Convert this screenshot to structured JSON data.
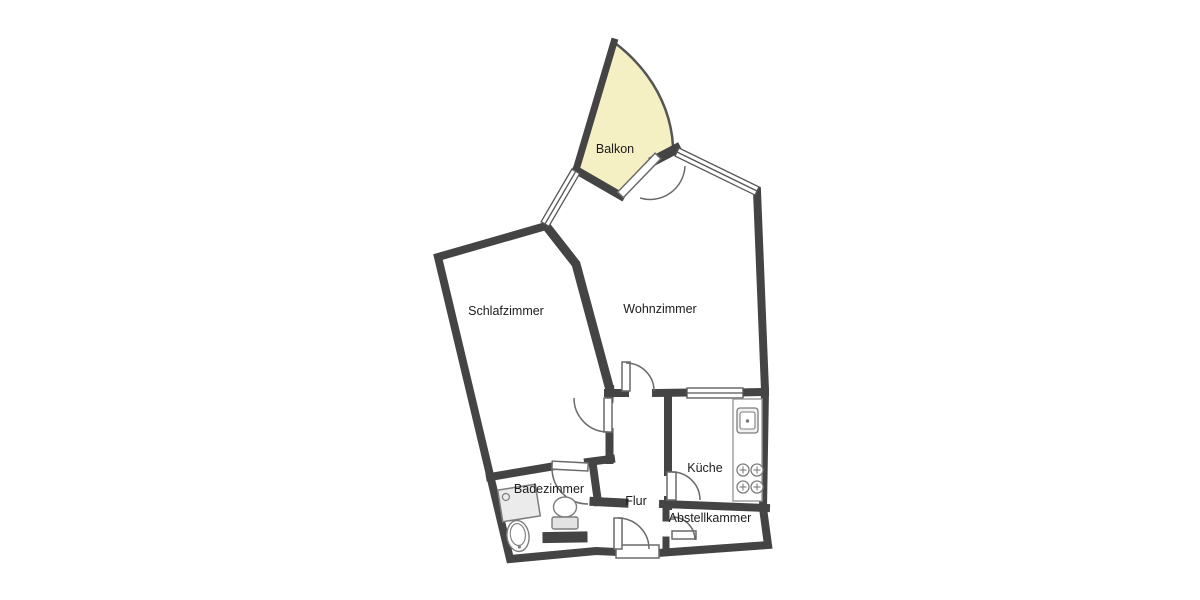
{
  "floorplan": {
    "type": "apartment-floor-plan",
    "background_color": "#ffffff",
    "wall_color": "#444444",
    "balcony_fill": "#f5f0c4",
    "line_color": "#6a6a6a",
    "fixture_line_color": "#7d7d7d",
    "label_color": "#1c1c1c",
    "labels": {
      "balkon": "Balkon",
      "schlafzimmer": "Schlafzimmer",
      "wohnzimmer": "Wohnzimmer",
      "badezimmer": "Badezimmer",
      "flur": "Flur",
      "kueche": "Küche",
      "abstellkammer": "Abstellkammer"
    },
    "windows": [
      "balcony-left-window",
      "balcony-right-window",
      "kitchen-pass-window"
    ],
    "doors": [
      "balcony-door",
      "living-room-door",
      "bedroom-door",
      "bathroom-door",
      "kitchen-door",
      "storage-door",
      "entrance-door"
    ],
    "fixtures": [
      "shower",
      "washbasin",
      "toilet",
      "kitchen-counter",
      "kitchen-sink",
      "stove"
    ]
  }
}
